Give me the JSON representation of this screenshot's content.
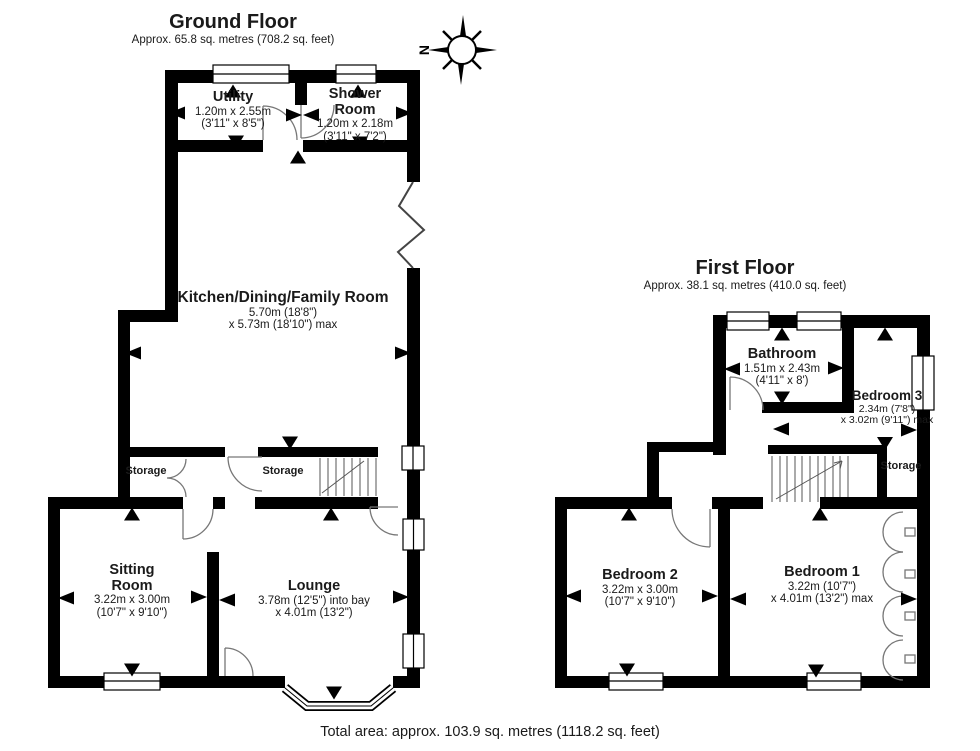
{
  "footer": {
    "total_area": "Total area: approx. 103.9 sq. metres (1118.2 sq. feet)"
  },
  "compass": {
    "label": "N"
  },
  "ground_floor": {
    "title": "Ground Floor",
    "subtitle": "Approx. 65.8 sq. metres (708.2 sq. feet)",
    "rooms": {
      "utility": {
        "name": "Utility",
        "dims_metric": "1.20m x 2.55m",
        "dims_imperial": "(3'11\" x 8'5\")"
      },
      "shower_room": {
        "name": "Shower Room",
        "dims_metric": "1.20m x 2.18m",
        "dims_imperial": "(3'11\" x 7'2\")"
      },
      "kitchen_dining_family": {
        "name": "Kitchen/Dining/Family Room",
        "dims_metric": "5.70m (18'8\")",
        "dims_imperial": "x 5.73m (18'10\") max"
      },
      "storage_left": {
        "name": "Storage"
      },
      "storage_hall": {
        "name": "Storage"
      },
      "sitting_room": {
        "name": "Sitting Room",
        "dims_metric": "3.22m x 3.00m",
        "dims_imperial": "(10'7\" x 9'10\")"
      },
      "lounge": {
        "name": "Lounge",
        "dims_metric": "3.78m (12'5\") into bay",
        "dims_imperial": "x 4.01m (13'2\")"
      }
    }
  },
  "first_floor": {
    "title": "First Floor",
    "subtitle": "Approx. 38.1 sq. metres (410.0 sq. feet)",
    "rooms": {
      "bathroom": {
        "name": "Bathroom",
        "dims_metric": "1.51m x 2.43m",
        "dims_imperial": "(4'11\" x 8')"
      },
      "bedroom3": {
        "name": "Bedroom 3",
        "dims_metric": "2.34m (7'8\")",
        "dims_imperial": "x 3.02m (9'11\") max"
      },
      "storage": {
        "name": "Storage"
      },
      "bedroom2": {
        "name": "Bedroom 2",
        "dims_metric": "3.22m x 3.00m",
        "dims_imperial": "(10'7\" x 9'10\")"
      },
      "bedroom1": {
        "name": "Bedroom 1",
        "dims_metric": "3.22m (10'7\")",
        "dims_imperial": "x 4.01m (13'2\") max"
      }
    }
  },
  "colors": {
    "wall": "#000000",
    "line": "#777777",
    "text": "#1a1a1a"
  }
}
